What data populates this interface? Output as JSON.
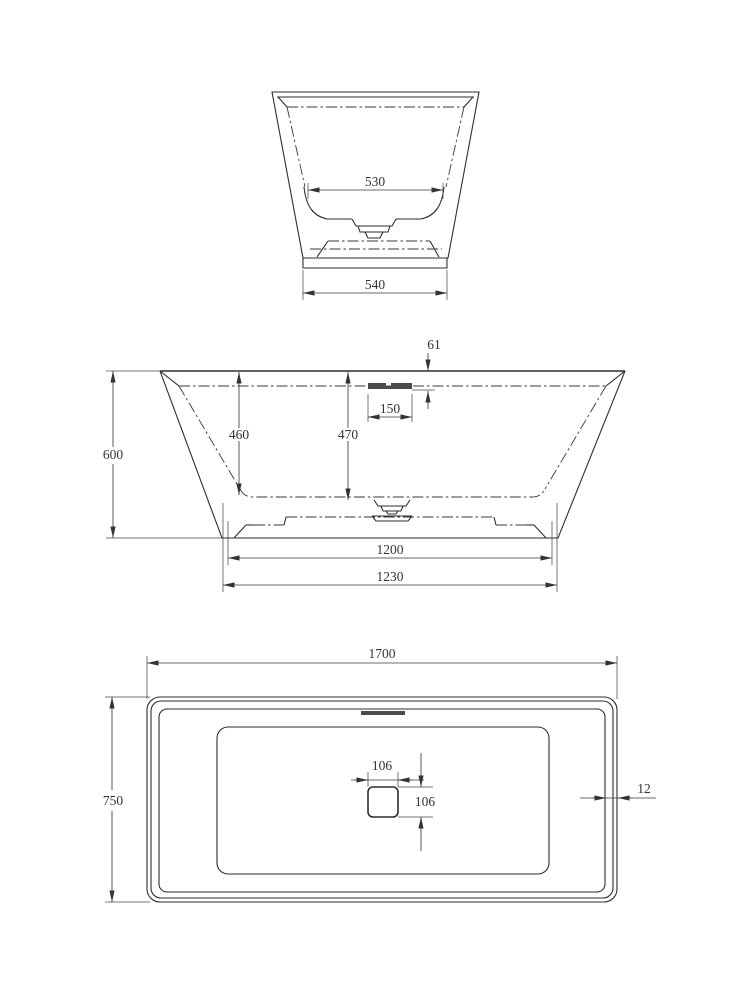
{
  "drawing": {
    "type": "technical-drawing",
    "subject": "freestanding bathtub — three orthographic views",
    "background_color": "#ffffff",
    "line_color": "#2e2e2e",
    "text_color": "#333333",
    "views": {
      "end_view": {
        "name": "end elevation",
        "dims": {
          "inner_bottom_width": "530",
          "base_width": "540"
        }
      },
      "front_view": {
        "name": "front elevation",
        "dims": {
          "overall_height": "600",
          "inner_depth_side": "460",
          "inner_depth_centre": "470",
          "rim_to_overflow": "61",
          "overflow_width": "150",
          "base_inner_length": "1200",
          "base_outer_length": "1230"
        }
      },
      "plan_view": {
        "name": "plan view",
        "dims": {
          "overall_length": "1700",
          "overall_width": "750",
          "drain_width": "106",
          "drain_depth": "106",
          "rim_thickness": "12"
        }
      }
    }
  }
}
